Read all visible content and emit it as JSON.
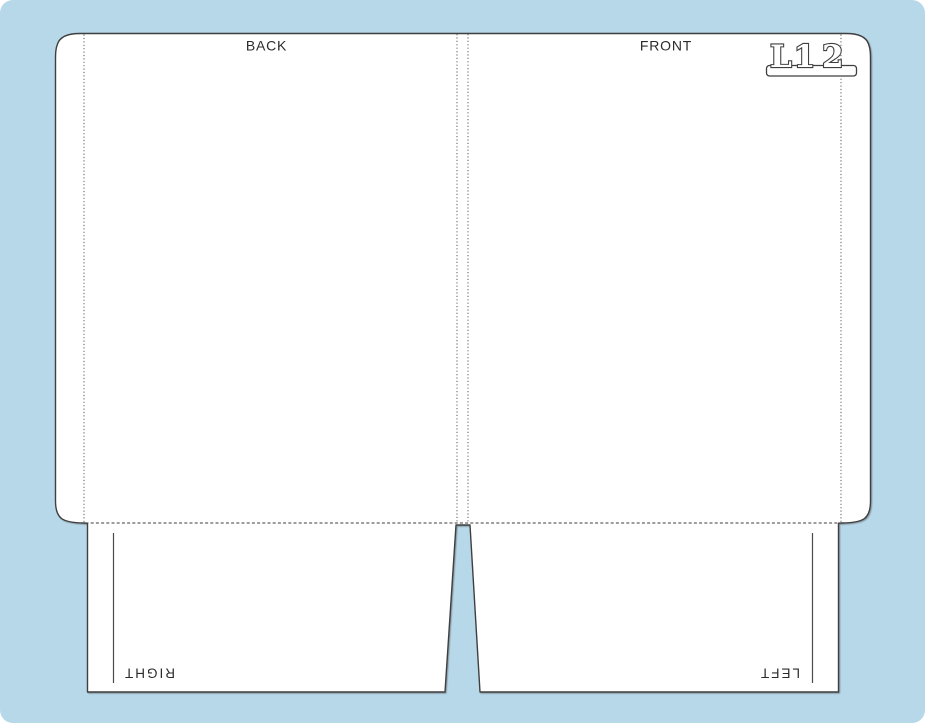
{
  "colors": {
    "page_background": "#ffffff",
    "canvas_background": "#b7d8e9",
    "shape_fill": "#ffffff",
    "cut_outline": "#3f3f3f",
    "fold_line": "#5a5a5a",
    "label_text": "#2b2b2b"
  },
  "dieline": {
    "back_panel_label": "BACK",
    "front_panel_label": "FRONT",
    "right_pocket_label": "RIGHT",
    "left_pocket_label": "LEFT",
    "mark": {
      "left_part": "L1",
      "right_part": "2"
    }
  }
}
